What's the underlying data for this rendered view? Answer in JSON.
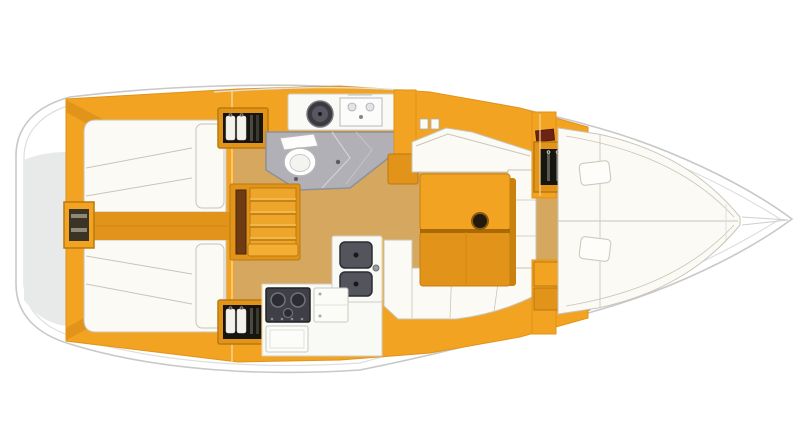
{
  "diagram": {
    "kind": "sailboat-interior-floorplan",
    "orientation": "bow-right",
    "rooms": [
      "aft-cabin-port",
      "aft-cabin-starboard",
      "companionway",
      "head-bathroom",
      "galley",
      "saloon-dinette",
      "forward-v-berth-cabin"
    ]
  },
  "colors": {
    "page": "#ffffff",
    "hull": "#ffffff",
    "hullLine": "#c8c8c8",
    "deckLine": "#dedede",
    "transom": "#e8eae9",
    "wood": "#f1a321",
    "woodDeep": "#e2931a",
    "woodDark": "#b97a10",
    "woodLine": "#c8830f",
    "woodPale": "#f8d79b",
    "plank": "#6e3b12",
    "floor": "#d6a75f",
    "berth": "#fbfaf4",
    "berthLine": "#c9c5b8",
    "headFloor": "#b0b0b6",
    "headWall": "#8f8f97",
    "white": "#f9f9f5",
    "whiteLine": "#cfcfc9",
    "dark": "#16160e",
    "steel": "#53545c",
    "steelDark": "#2b2c32",
    "steelMid": "#3f4046",
    "shirt": "#f3f2ec",
    "hanger": "#8c8c84",
    "accentRed": "#6e2414",
    "tableShadow": "#c9820d",
    "tableRail": "#a96a06"
  }
}
